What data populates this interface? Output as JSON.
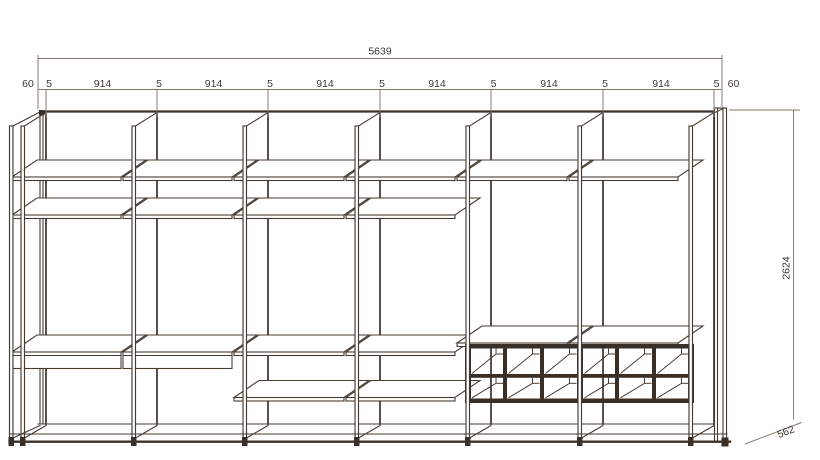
{
  "dimensions": {
    "total_width": "5639",
    "width_segments": [
      "60",
      "5",
      "914",
      "5",
      "914",
      "5",
      "914",
      "5",
      "914",
      "5",
      "914",
      "5",
      "914",
      "5",
      "60"
    ],
    "height": "2624",
    "depth": "562"
  }
}
